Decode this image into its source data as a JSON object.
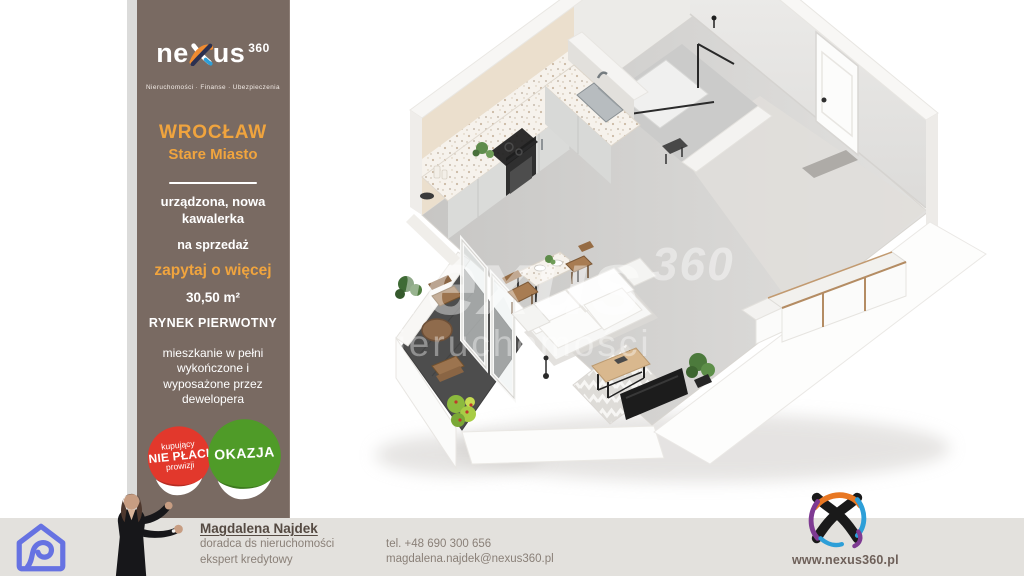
{
  "brand": {
    "pre": "ne",
    "post": "us",
    "sup": "360",
    "tagline": "Nieruchomości · Finanse · Ubezpieczenia"
  },
  "sidebar": {
    "city": "WROCŁAW",
    "district": "Stare Miasto",
    "description": "urządzona, nowa kawalerka",
    "offer_type": "na sprzedaż",
    "cta": "zapytaj o więcej",
    "area": "30,50 m²",
    "market": "RYNEK PIERWOTNY",
    "details": "mieszkanie w pełni wykończone i wyposażone przez dewelopera",
    "badge_red": {
      "line1": "kupujący",
      "line2": "NIE PŁACI",
      "line3": "prowizji"
    },
    "badge_green": {
      "label": "OKAZJA"
    }
  },
  "watermark": {
    "brand": "nexus",
    "sup": "360",
    "sub": "nieruchomości"
  },
  "footer": {
    "name": "Magdalena Najdek",
    "role1": "doradca ds nieruchomości",
    "role2": "ekspert kredytowy",
    "phone": "tel. +48 690 300 656",
    "email": "magdalena.najdek@nexus360.pl",
    "website": "www.nexus360.pl"
  },
  "colors": {
    "sidebar_bg": "#796a62",
    "accent_orange": "#f0a43e",
    "badge_red": "#e2382c",
    "badge_green": "#4f9b28",
    "footer_bar": "#e3e1dd",
    "icon_blue": "#6672e2",
    "logo_orange": "#e87722",
    "logo_blue": "#2d9fd8",
    "logo_purple": "#7e3a92",
    "text_light": "#ffffff",
    "text_gray": "#8a8078"
  }
}
